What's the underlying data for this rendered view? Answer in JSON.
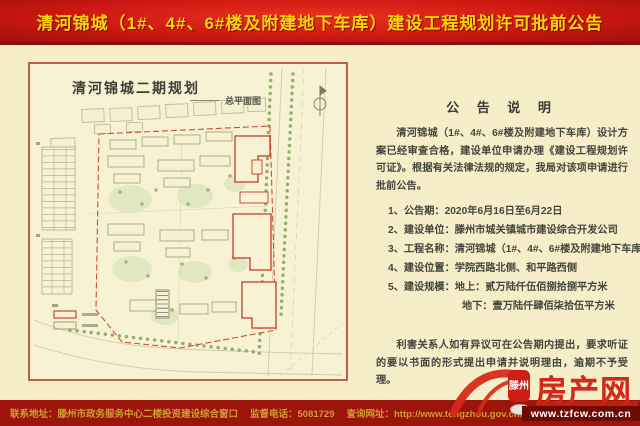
{
  "header": {
    "title": "清河锦城（1#、4#、6#楼及附建地下车库）建设工程规划许可批前公告"
  },
  "map_panel": {
    "title": "清河锦城二期规划",
    "legend_label": "总平面图"
  },
  "notice": {
    "heading": "公 告 说 明",
    "intro": "清河锦城（1#、4#、6#楼及附建地下车库）设计方案已经审查合格，建设单位申请办理《建设工程规划许可证》。根据有关法律法规的规定，我局对该项申请进行批前公告。",
    "items": [
      "1、公告期：2020年6月16日至6月22日",
      "2、建设单位：滕州市城关镇城市建设综合开发公司",
      "3、工程名称：清河锦城（1#、4#、6#楼及附建地下车库）",
      "4、建设位置：学院西路北侧、和平路西侧",
      "5、建设规模：地上：贰万陆仟伍佰捌拾捌平方米"
    ],
    "item5_sub": "地下：壹万陆仟肆佰柒拾伍平方米",
    "closing": "利害关系人如有异议可在公告期内提出，要求听证的要以书面的形式提出申请并说明理由，逾期不予受理。"
  },
  "footer": {
    "address": "联系地址：滕州市政务服务中心二楼投资建设综合窗口",
    "phone": "监督电话：5081729",
    "website": "查询网址：http://www.tengzhou.gov.cn/zzq/zfbm/"
  },
  "watermark": {
    "seal_text": "滕州",
    "site_name": "房产网",
    "site_url": "www.tzfcw.com.cn"
  },
  "colors": {
    "header_red": "#cf1812",
    "title_yellow": "#ffd404",
    "body_cream": "#f5eec8",
    "panel_border": "#b9604c",
    "footer_red": "#9c140a",
    "footer_gold": "#cf9c33",
    "boundary_red": "#d44a35",
    "approved_building_red": "#c63a28",
    "tree_green": "#8fb06c",
    "watermark_red": "#d6281a"
  }
}
